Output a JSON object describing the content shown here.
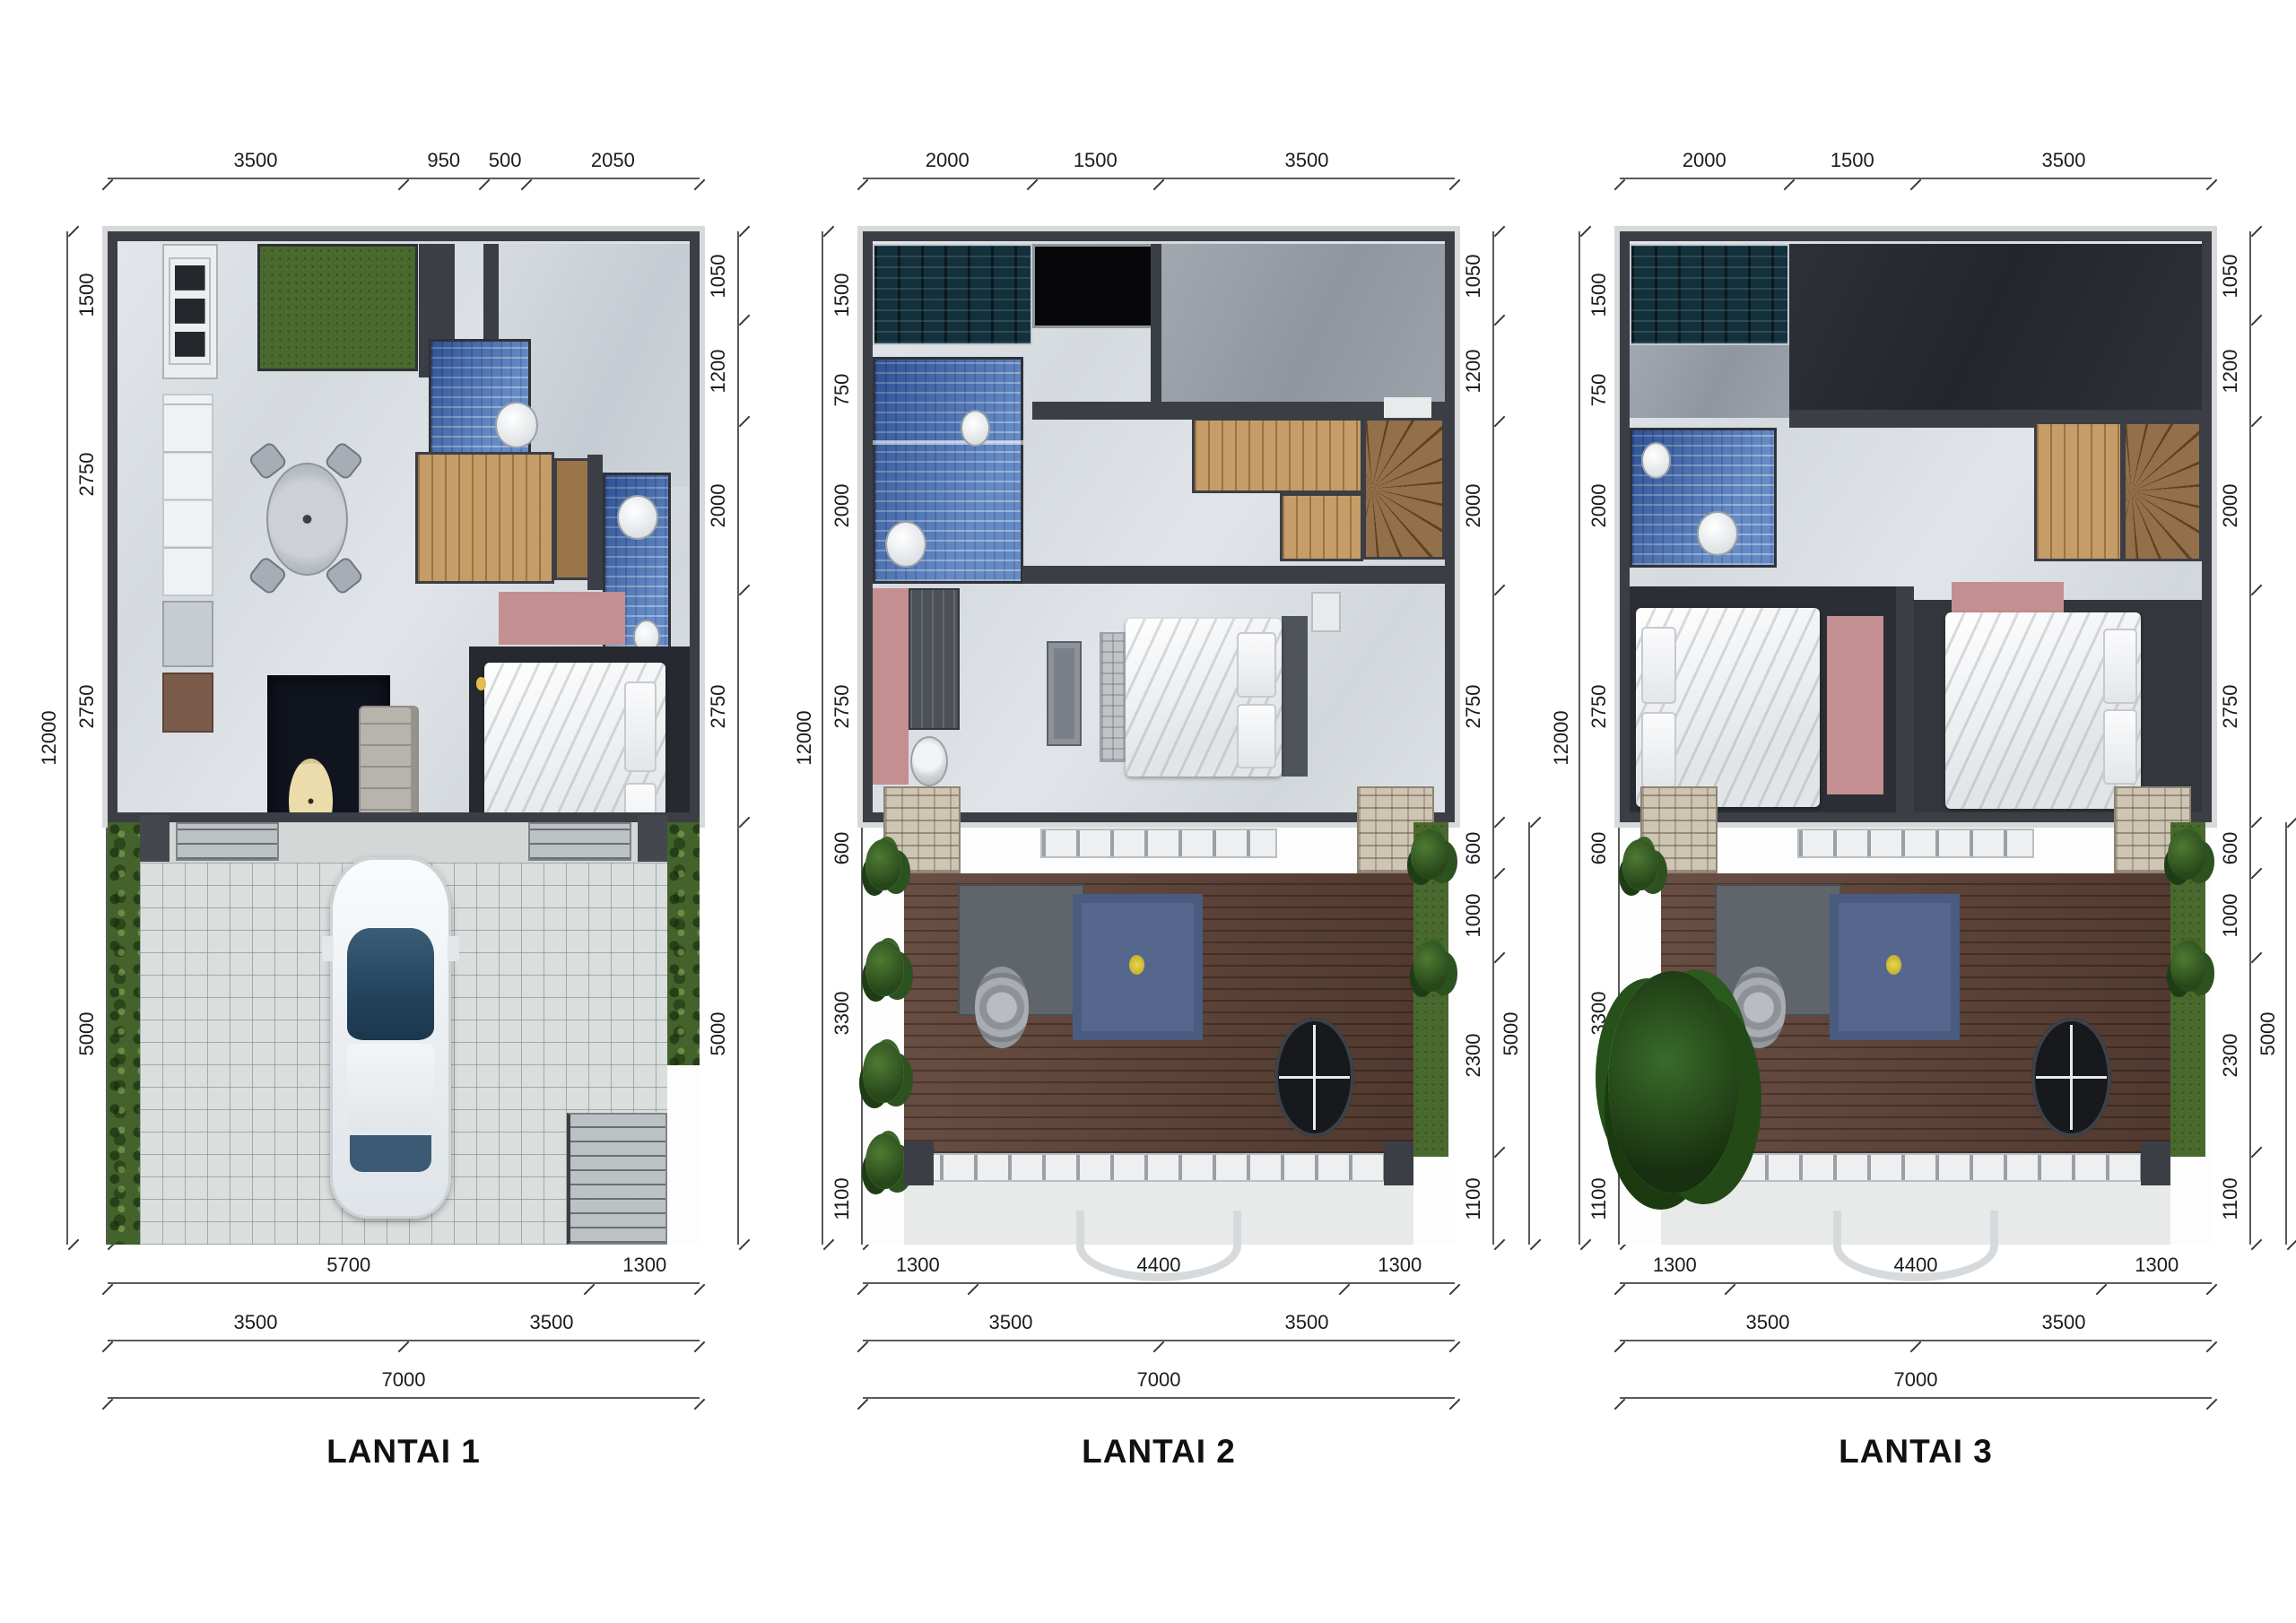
{
  "palette": {
    "wall": "#3b3e45",
    "marble_floor": "#dce1e6",
    "room_gray": "#d2d7dc",
    "concrete": "#99a0a9",
    "roof": "#2d3136",
    "grass": "#4a6b2f",
    "tile_blue": "#4574b9",
    "tile_teal": "#16333f",
    "wood_stair": "#c39b67",
    "deck": "#5e4136",
    "rug_navy": "#10141f",
    "rug_pink": "#c4908f",
    "rug_blue": "#57688f",
    "paving": "#d9dddb",
    "stone": "#cfc5b3",
    "car_glass": "#2e4d6b",
    "dim_line": "#4a4a4a",
    "dim_text": "#1b1b1b"
  },
  "floors": [
    {
      "label": "LANTAI 1",
      "dims": {
        "top": [
          "3500",
          "950",
          "500",
          "2050"
        ],
        "left_overall": "12000",
        "left": [
          "1500",
          "2750",
          "2750",
          "5000"
        ],
        "right": [
          "1050",
          "1200",
          "2000",
          "2750",
          "5000"
        ],
        "bottom_row1": [
          "5700",
          "1300"
        ],
        "bottom_row2": [
          "3500",
          "3500"
        ],
        "bottom_row3": [
          "7000"
        ]
      }
    },
    {
      "label": "LANTAI 2",
      "dims": {
        "top": [
          "2000",
          "1500",
          "3500"
        ],
        "left_overall": "12000",
        "left": [
          "1500",
          "750",
          "2000",
          "2750",
          "600",
          "3300",
          "1100"
        ],
        "right": [
          "1050",
          "1200",
          "2000",
          "2750",
          "600",
          "1000",
          "2300",
          "1100"
        ],
        "right_outer": "5000",
        "bottom_row1": [
          "1300",
          "4400",
          "1300"
        ],
        "bottom_row2": [
          "3500",
          "3500"
        ],
        "bottom_row3": [
          "7000"
        ]
      }
    },
    {
      "label": "LANTAI 3",
      "dims": {
        "top": [
          "2000",
          "1500",
          "3500"
        ],
        "left_overall": "12000",
        "left": [
          "1500",
          "750",
          "2000",
          "2750",
          "600",
          "3300",
          "1100"
        ],
        "right": [
          "1050",
          "1200",
          "2000",
          "2750",
          "600",
          "1000",
          "2300",
          "1100"
        ],
        "right_outer": "5000",
        "bottom_row1": [
          "1300",
          "4400",
          "1300"
        ],
        "bottom_row2": [
          "3500",
          "3500"
        ],
        "bottom_row3": [
          "7000"
        ]
      }
    }
  ]
}
